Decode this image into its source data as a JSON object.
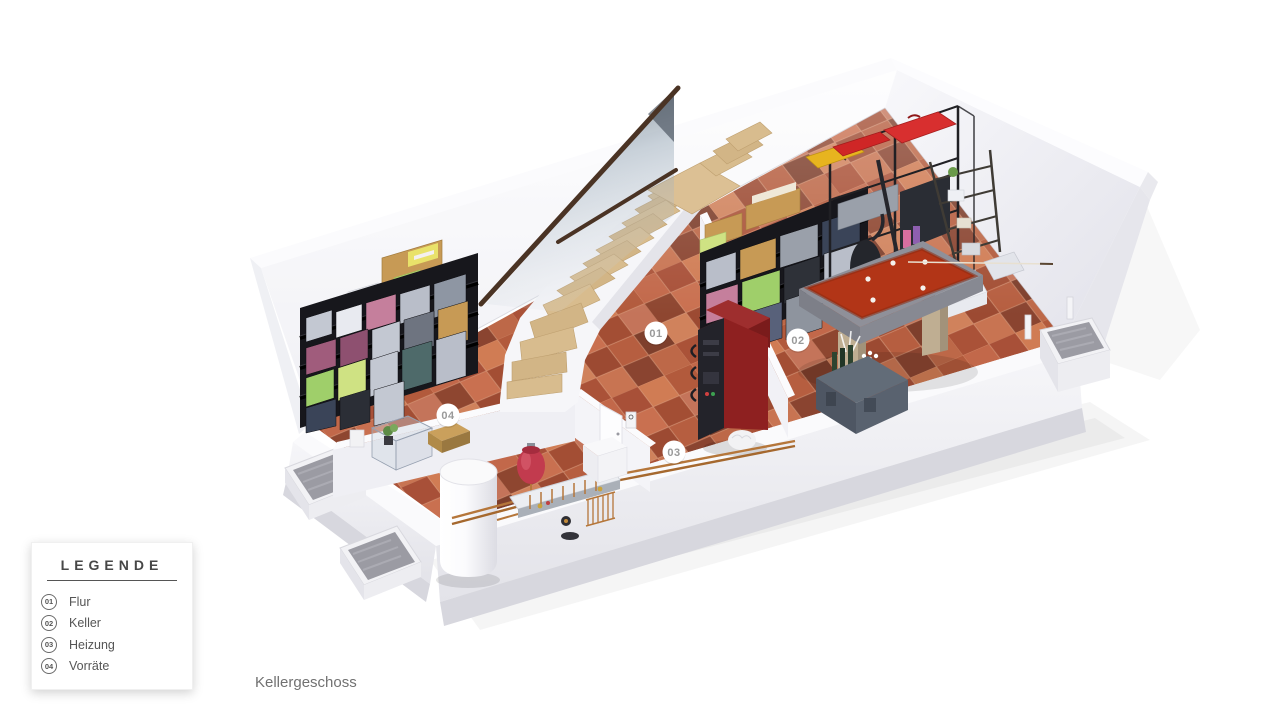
{
  "title": "Kellergeschoss",
  "legend": {
    "title": "LEGENDE",
    "items": [
      {
        "number": "01",
        "label": "Flur"
      },
      {
        "number": "02",
        "label": "Keller"
      },
      {
        "number": "03",
        "label": "Heizung"
      },
      {
        "number": "04",
        "label": "Vorräte"
      }
    ]
  },
  "markers": [
    {
      "id": "01",
      "room": "Flur"
    },
    {
      "id": "02",
      "room": "Keller"
    },
    {
      "id": "03",
      "room": "Heizung"
    },
    {
      "id": "04",
      "room": "Vorräte"
    }
  ],
  "objects": [
    "staircase",
    "glass-balustrade",
    "pool-table",
    "boiler",
    "hot-water-tank",
    "expansion-vessel",
    "heating-manifold",
    "storage-shelf-left",
    "storage-shelves-back",
    "metal-rack",
    "ladder-shelf",
    "sideboard-with-bottles",
    "display-case",
    "wooden-crate",
    "white-cabinet",
    "window-well-left-1",
    "window-well-left-2",
    "window-well-right"
  ],
  "colors": {
    "floor_terracotta": "#c26948",
    "wall_white": "#f2f2f6",
    "pool_table_felt": "#b23517",
    "boiler_red": "#8e2020",
    "stairs_wood": "#d8bc8e",
    "handrail_brown": "#4a3324",
    "expansion_vessel": "#c23b4e",
    "marker_text": "#9a9a9a",
    "legend_text": "#555555"
  }
}
